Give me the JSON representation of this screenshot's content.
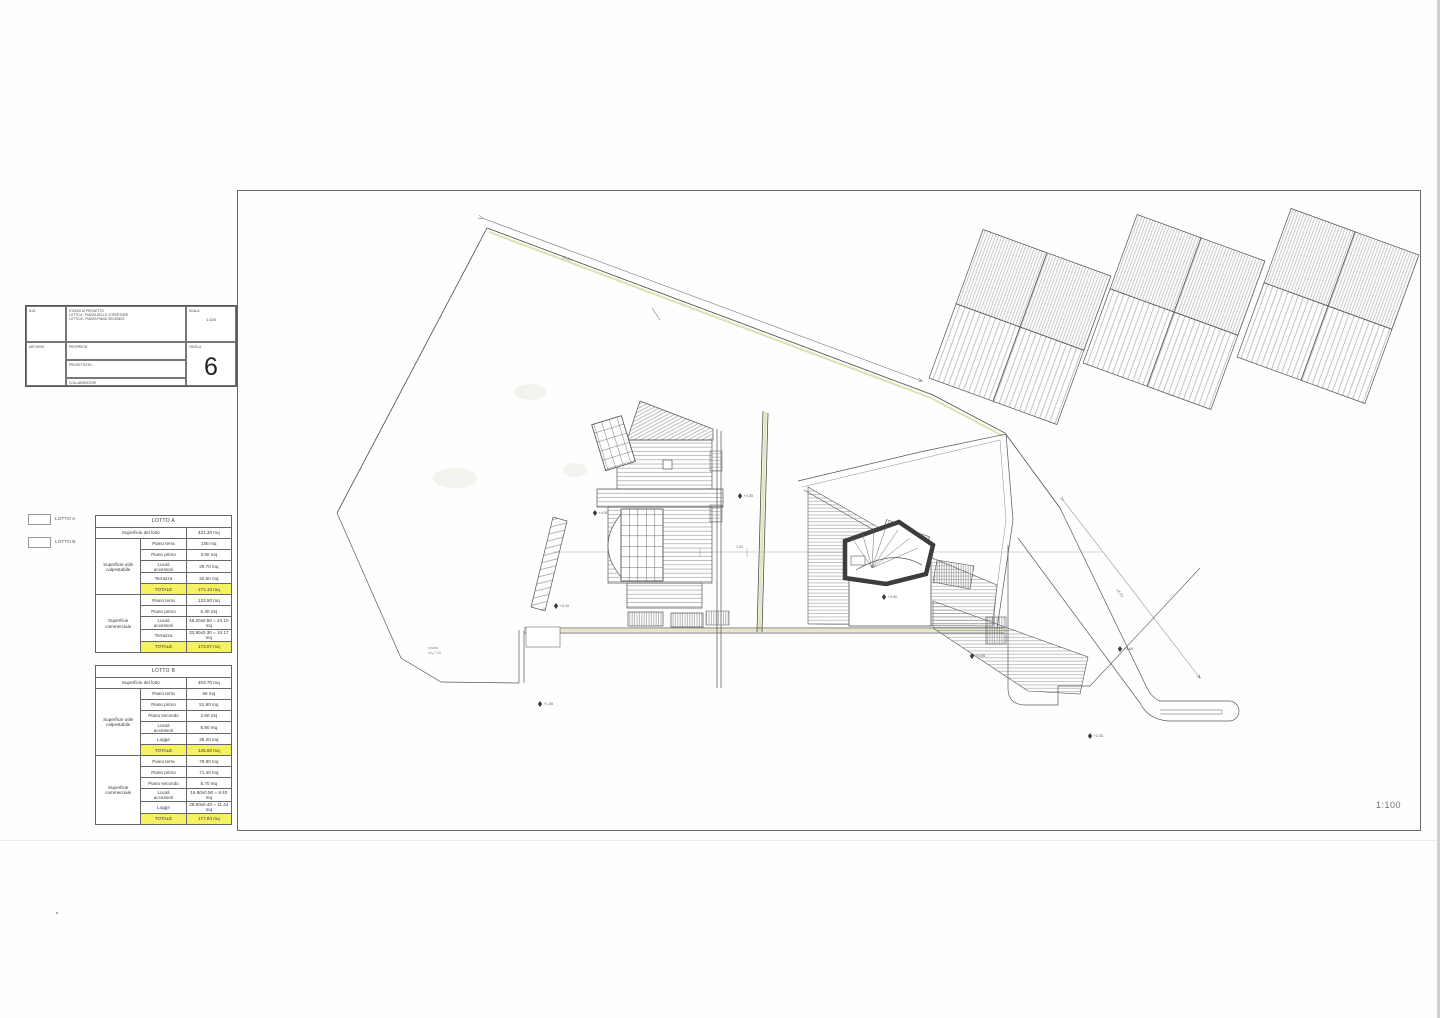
{
  "scale_note": "1:100",
  "title_block": {
    "ref": "N.61",
    "archive_label": "ARCHIVIO",
    "project_lines": [
      "STUDIO DI PROGETTO",
      "LOTTO A - PIANTA DELLE COPERTURE",
      "LOTTO B - PIANTA PIANO SECONDO"
    ],
    "property_label": "PROPRIETA'",
    "designer_label": "PROGETTISTA :",
    "collaborators_label": "COLLABORATORI",
    "scale_label": "SCALA",
    "scale_value": "1:100",
    "sheet_label": "TAVOLA",
    "sheet_number": "6"
  },
  "legend": {
    "items": [
      {
        "label": "LOTTO A"
      },
      {
        "label": "LOTTO B"
      }
    ]
  },
  "tables": [
    {
      "title": "LOTTO A",
      "lot_label": "Superficie del lotto",
      "lot_value": "421.30 mq",
      "groups": [
        {
          "name": "Superficie utile\ncalpestabile",
          "rows": [
            [
              "Piano terra",
              "105 mq"
            ],
            [
              "Piano primo",
              "3.80 mq"
            ],
            [
              "Locali\naccessori",
              "29.70 mq"
            ],
            [
              "Terrazza",
              "32.60 mq"
            ]
          ],
          "total": [
            "TOTALE",
            "171.10 mq"
          ]
        },
        {
          "name": "Superficie\ncommerciale",
          "rows": [
            [
              "Piano terra",
              "133.50 mq"
            ],
            [
              "Piano primo",
              "5.30 mq"
            ],
            [
              "Locali\naccessori",
              "48.20x0.50 = 24.10 mq"
            ],
            [
              "Terrazza",
              "33.90x0.30 = 10.17 mq"
            ]
          ],
          "total": [
            "TOTALE",
            "173.07 mq"
          ]
        }
      ]
    },
    {
      "title": "LOTTO B",
      "lot_label": "Superficie del lotto",
      "lot_value": "403.70 mq",
      "groups": [
        {
          "name": "Superficie utile\ncalpestabile",
          "rows": [
            [
              "Piano terra",
              "56 mq"
            ],
            [
              "Piano primo",
              "51.90 mq"
            ],
            [
              "Piano secondo",
              "2.60 mq"
            ],
            [
              "Locali\naccessori",
              "6.90 mq"
            ],
            [
              "Logge",
              "28.20 mq"
            ]
          ],
          "total": [
            "TOTALE",
            "145.60 mq"
          ]
        },
        {
          "name": "Superficie\ncommerciale",
          "rows": [
            [
              "Piano terra",
              "79.90 mq"
            ],
            [
              "Piano primo",
              "71.40 mq"
            ],
            [
              "Piano secondo",
              "5.70 mq"
            ],
            [
              "Locali\naccessori",
              "16.80x0.50 = 8.40 mq"
            ],
            [
              "Logge",
              "28.60x0.40 = 11.44 mq"
            ]
          ],
          "total": [
            "TOTALE",
            "177.84 mq"
          ]
        }
      ]
    }
  ],
  "drawing": {
    "road_note_lines": [
      "strada",
      "mq 7.06"
    ],
    "level_markers": [
      {
        "x": 740,
        "y": 496,
        "label": "+4.35"
      },
      {
        "x": 595,
        "y": 513,
        "label": "+4.50"
      },
      {
        "x": 556,
        "y": 606,
        "label": "+4.10"
      },
      {
        "x": 540,
        "y": 704,
        "label": "+1.35"
      },
      {
        "x": 884,
        "y": 597,
        "label": "+4.30"
      },
      {
        "x": 972,
        "y": 656,
        "label": "+4.05"
      },
      {
        "x": 1120,
        "y": 649,
        "label": "+3.60"
      },
      {
        "x": 1090,
        "y": 736,
        "label": "+2.35"
      }
    ],
    "dim_labels": [
      {
        "x": 562,
        "y": 258,
        "rot": 20,
        "text": "23.05"
      },
      {
        "x": 1116,
        "y": 590,
        "rot": 52,
        "text": "14.60"
      },
      {
        "x": 736,
        "y": 548,
        "rot": 0,
        "text": "1.50"
      }
    ]
  },
  "colors": {
    "highlight": "#f4f163",
    "boundary_yellow": "#d8d89a",
    "line": "#4a4a4a"
  }
}
